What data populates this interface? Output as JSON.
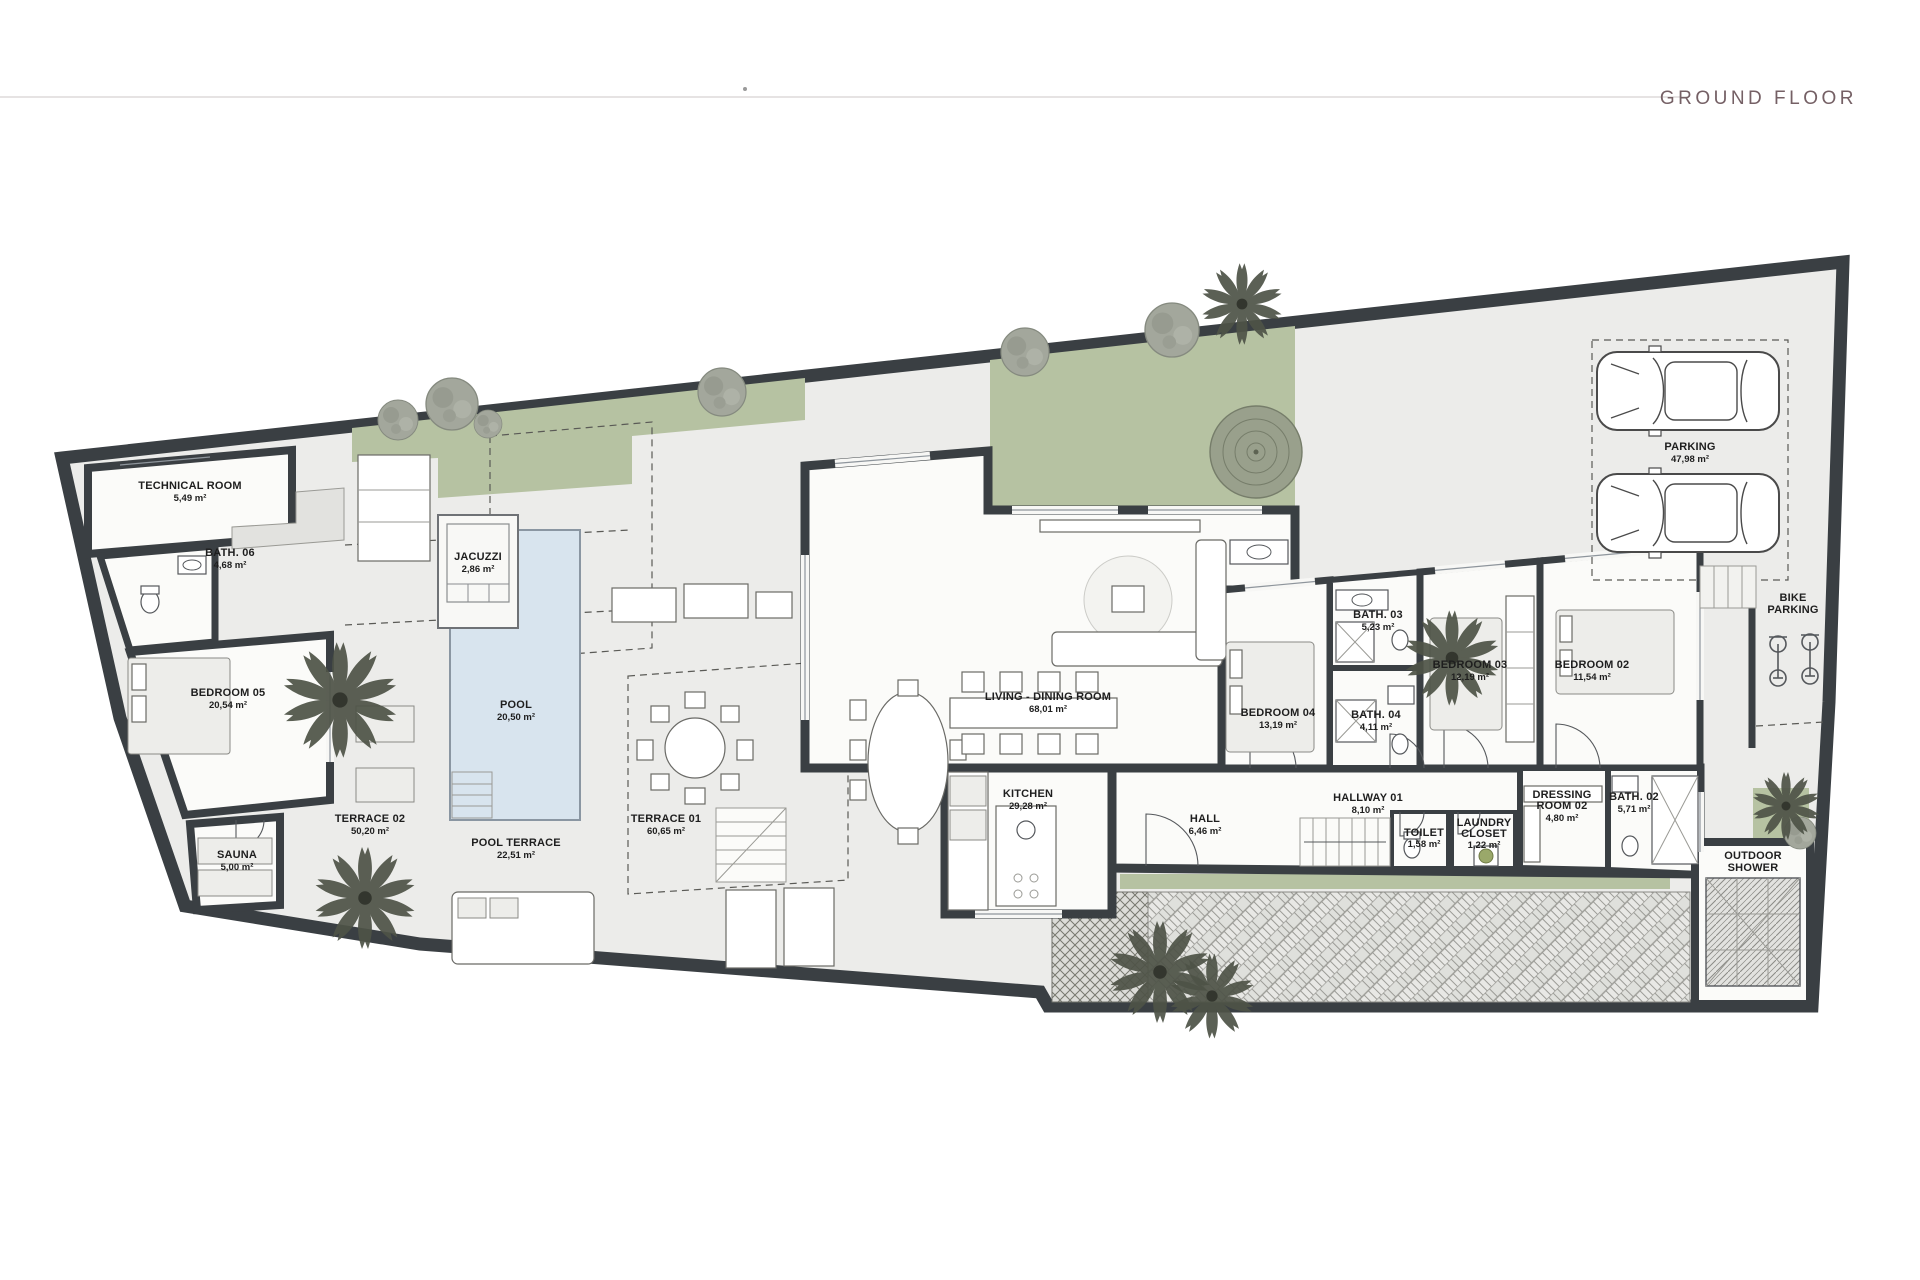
{
  "header": {
    "title": "GROUND FLOOR"
  },
  "rooms": {
    "technical_room": {
      "label": "TECHNICAL ROOM",
      "area": "5,49 m²"
    },
    "bath_06": {
      "label": "BATH. 06",
      "area": "4,68 m²"
    },
    "bedroom_05": {
      "label": "BEDROOM 05",
      "area": "20,54 m²"
    },
    "sauna": {
      "label": "SAUNA",
      "area": "5,00 m²"
    },
    "terrace_02": {
      "label": "TERRACE 02",
      "area": "50,20 m²"
    },
    "jacuzzi": {
      "label": "JACUZZI",
      "area": "2,86 m²"
    },
    "pool": {
      "label": "POOL",
      "area": "20,50 m²"
    },
    "pool_terrace": {
      "label": "POOL TERRACE",
      "area": "22,51 m²"
    },
    "terrace_01": {
      "label": "TERRACE 01",
      "area": "60,65 m²"
    },
    "living_dining": {
      "label": "LIVING - DINING ROOM",
      "area": "68,01 m²"
    },
    "kitchen": {
      "label": "KITCHEN",
      "area": "29,28 m²"
    },
    "hall": {
      "label": "HALL",
      "area": "6,46 m²"
    },
    "hallway_01": {
      "label": "HALLWAY 01",
      "area": "8,10 m²"
    },
    "toilet": {
      "label": "TOILET",
      "area": "1,58 m²"
    },
    "laundry_closet": {
      "line1": "LAUNDRY",
      "line2": "CLOSET",
      "area": "1,22 m²"
    },
    "bedroom_04": {
      "label": "BEDROOM 04",
      "area": "13,19 m²"
    },
    "bath_04": {
      "label": "BATH. 04",
      "area": "4,11 m²"
    },
    "bath_03": {
      "label": "BATH. 03",
      "area": "5,23 m²"
    },
    "bedroom_03": {
      "label": "BEDROOM 03",
      "area": "12,19 m²"
    },
    "bedroom_02": {
      "label": "BEDROOM 02",
      "area": "11,54 m²"
    },
    "dressing_room_02": {
      "line1": "DRESSING",
      "line2": "ROOM 02",
      "area": "4,80 m²"
    },
    "bath_02": {
      "label": "BATH. 02",
      "area": "5,71 m²"
    },
    "parking": {
      "label": "PARKING",
      "area": "47,98 m²"
    },
    "bike_parking": {
      "line1": "BIKE",
      "line2": "PARKING"
    },
    "outdoor_shower": {
      "line1": "OUTDOOR",
      "line2": "SHOWER"
    }
  },
  "colors": {
    "wall": "#3a3f43",
    "garden": "#b6c2a2",
    "pool_water": "#d8e4ee",
    "title": "#756065"
  }
}
